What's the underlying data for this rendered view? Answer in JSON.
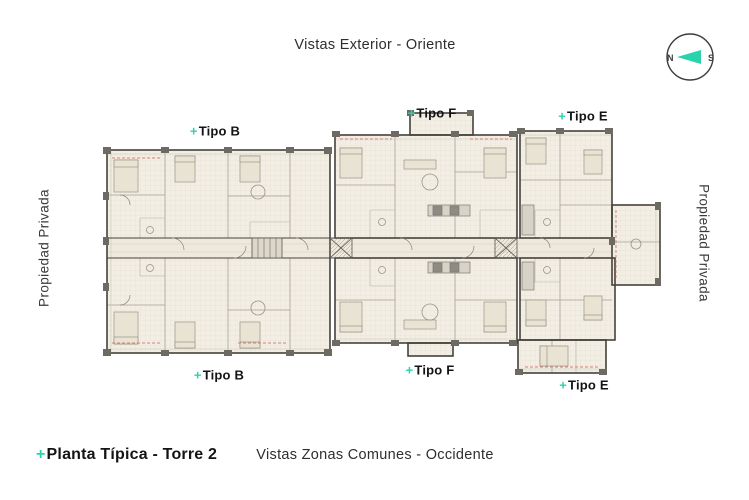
{
  "header": {
    "title": "Vistas Exterior - Oriente"
  },
  "footer": {
    "prefix": "+",
    "plan_title": "Planta Típica - Torre 2",
    "subtitle": "Vistas Zonas Comunes - Occidente"
  },
  "sides": {
    "left": "Propiedad Privada",
    "right": "Propiedad Privada"
  },
  "compass": {
    "north": "N",
    "south": "S"
  },
  "unit_labels": [
    {
      "id": "tipo-b-top",
      "prefix": "+",
      "name": "Tipo B"
    },
    {
      "id": "tipo-f-top",
      "prefix": "+",
      "name": "Tipo F"
    },
    {
      "id": "tipo-e-top",
      "prefix": "+",
      "name": "Tipo E"
    },
    {
      "id": "tipo-b-bottom",
      "prefix": "+",
      "name": "Tipo B"
    },
    {
      "id": "tipo-f-bottom",
      "prefix": "+",
      "name": "Tipo F"
    },
    {
      "id": "tipo-e-bottom",
      "prefix": "+",
      "name": "Tipo E"
    }
  ],
  "colors": {
    "accent_teal": "#2bd3ac",
    "text_dark": "#141416",
    "plan_cream": "#f2eee4",
    "plan_wall": "#45423b",
    "plan_light_line": "#c9c3b4",
    "plan_gray": "#6d6a63",
    "plan_red_dash": "#d67f76"
  }
}
